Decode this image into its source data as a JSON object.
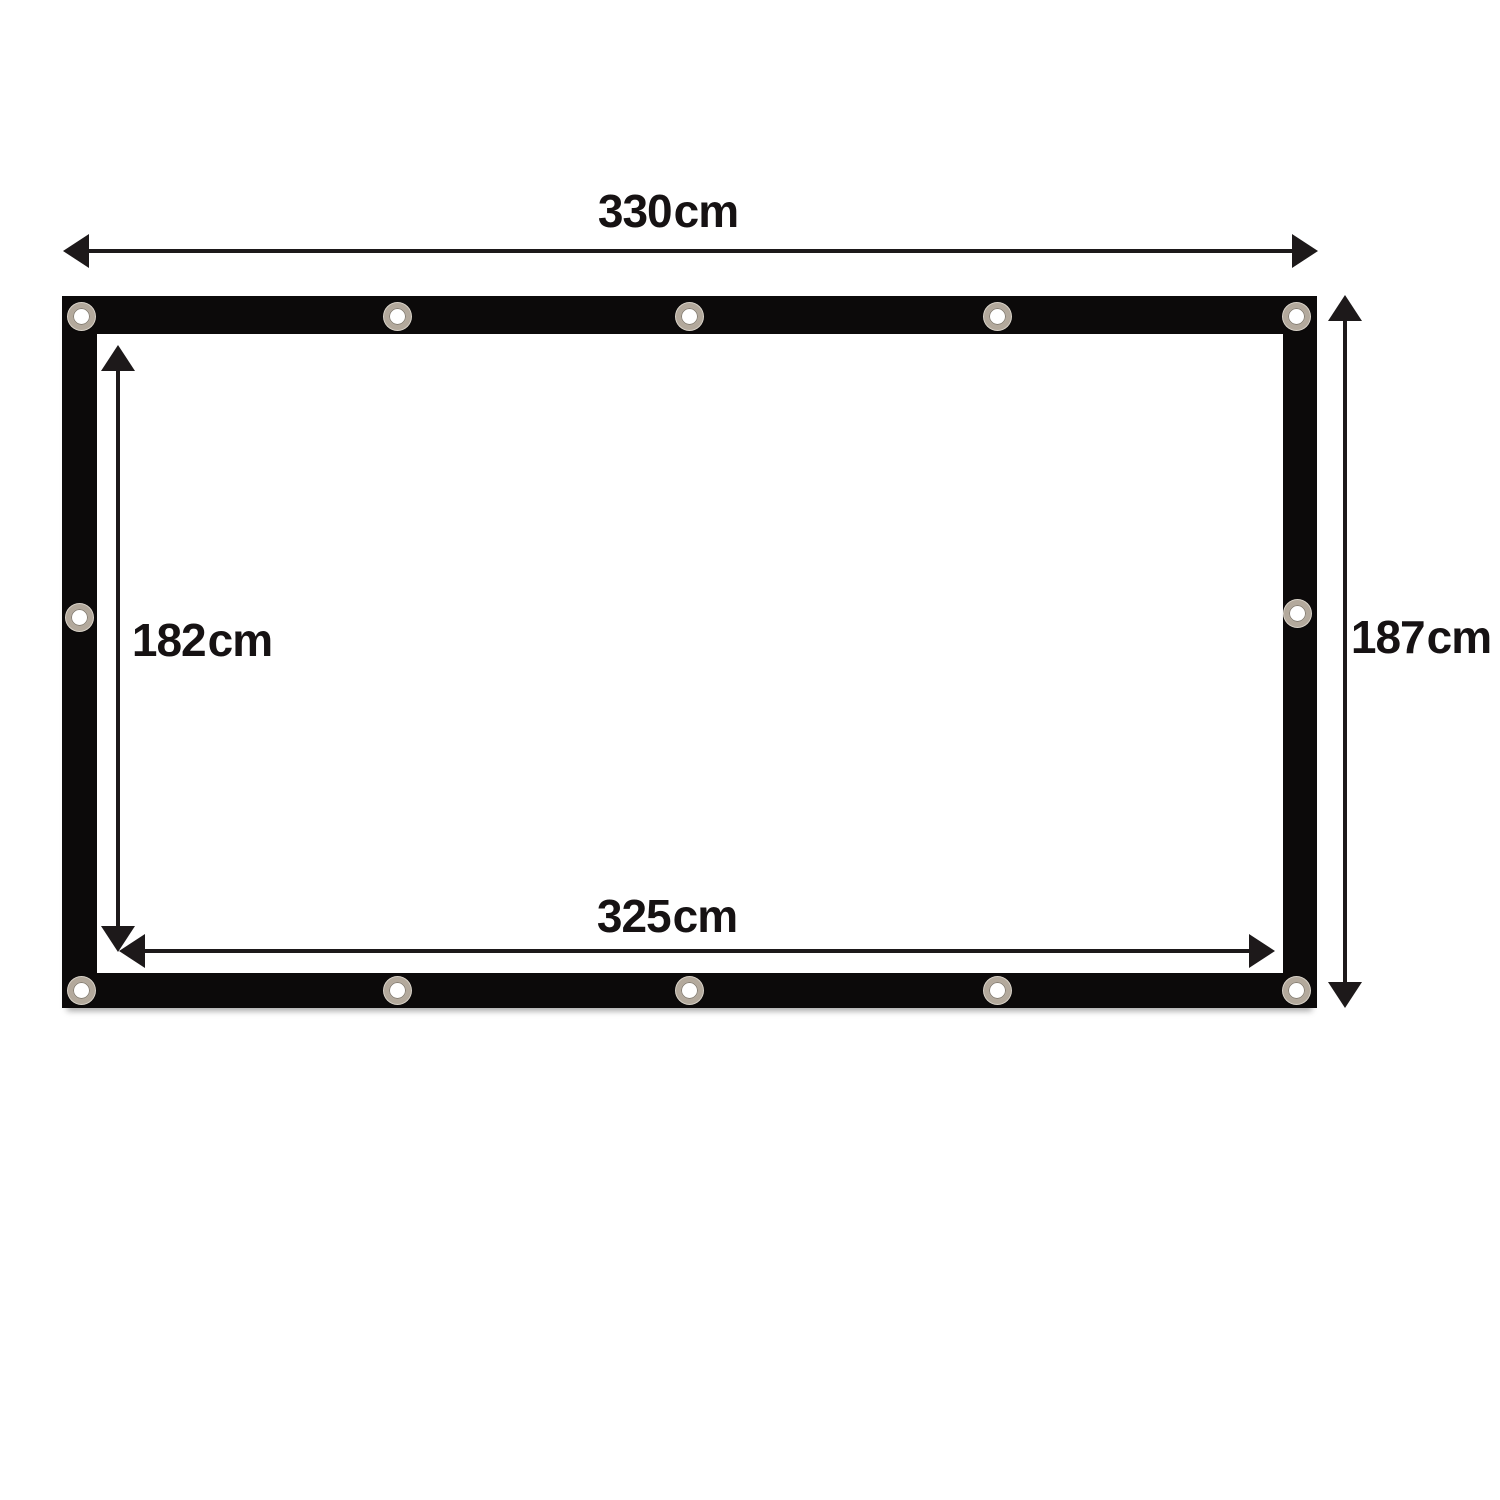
{
  "diagram": {
    "type": "product-dimension-diagram",
    "subject": "grommeted panel (projection screen / tarp) with black hem border and metal eyelets",
    "grommet_count": 14,
    "colors": {
      "background": "#ffffff",
      "frame": "#0c0a0a",
      "arrow": "#1d191a",
      "text": "#161213",
      "grommet_ring": "#b3a99c",
      "grommet_hole": "#ffffff"
    },
    "dimensions": {
      "outer_width": {
        "value": "330",
        "unit": "cm",
        "description": "total width, top arrow"
      },
      "outer_height": {
        "value": "187",
        "unit": "cm",
        "description": "total height, right arrow"
      },
      "inner_width": {
        "value": "325",
        "unit": "cm",
        "description": "inner viewing width, bottom inner arrow"
      },
      "inner_height": {
        "value": "182",
        "unit": "cm",
        "description": "inner viewing height, left inner arrow"
      }
    }
  }
}
